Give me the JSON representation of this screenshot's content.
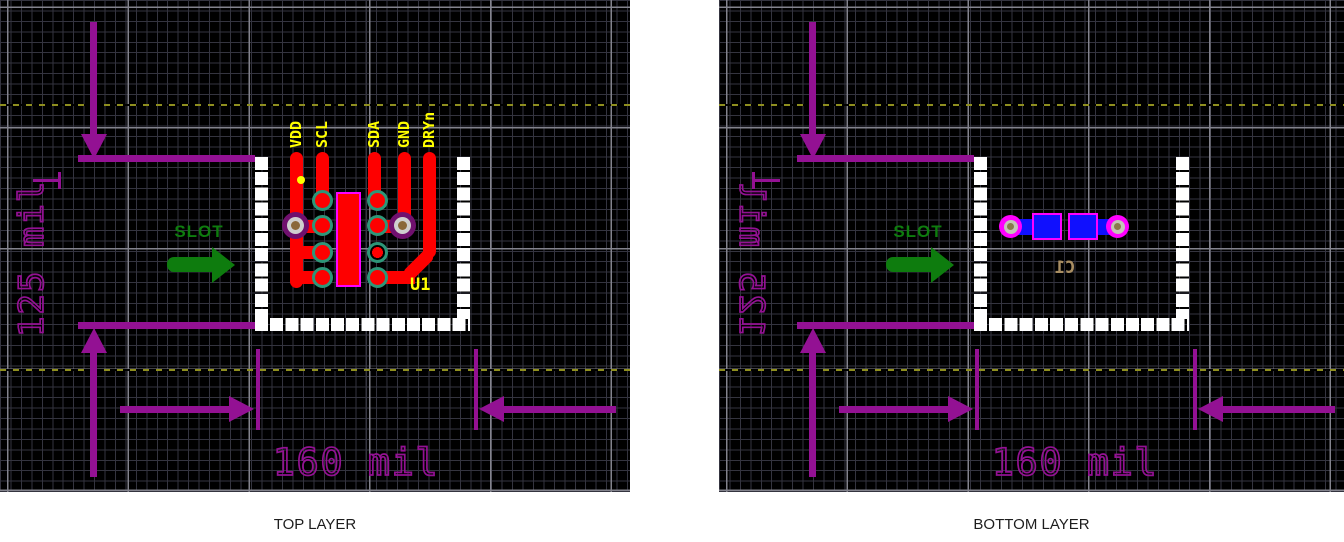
{
  "figure": {
    "panels": [
      {
        "layer": "top",
        "caption": "TOP LAYER",
        "slot_label": "SLOT",
        "dim_vertical": "125 mil",
        "dim_horizontal": "160 mil",
        "pin_labels": [
          "VDD",
          "SCL",
          "SDA",
          "GND",
          "DRYn"
        ],
        "designator": "U1"
      },
      {
        "layer": "bottom",
        "caption": "BOTTOM LAYER",
        "slot_label": "SLOT",
        "dim_vertical": "125 mil",
        "dim_horizontal": "160 mil",
        "pin_labels": [],
        "designator": "C1"
      }
    ],
    "colors": {
      "dimension_purple": "#931193",
      "copper_top_red": "#fe0000",
      "copper_bottom_blue": "#1010fe",
      "pad_ring_teal": "#2d9678",
      "pad_outline_magenta": "#ff00ff",
      "silkscreen_top_yellow": "#ffff00",
      "silkscreen_bottom_tan": "#a98e62",
      "slot_outline_white": "#ffffff",
      "slot_marker_green": "#0e7c0e",
      "grid_background": "#000000"
    }
  }
}
